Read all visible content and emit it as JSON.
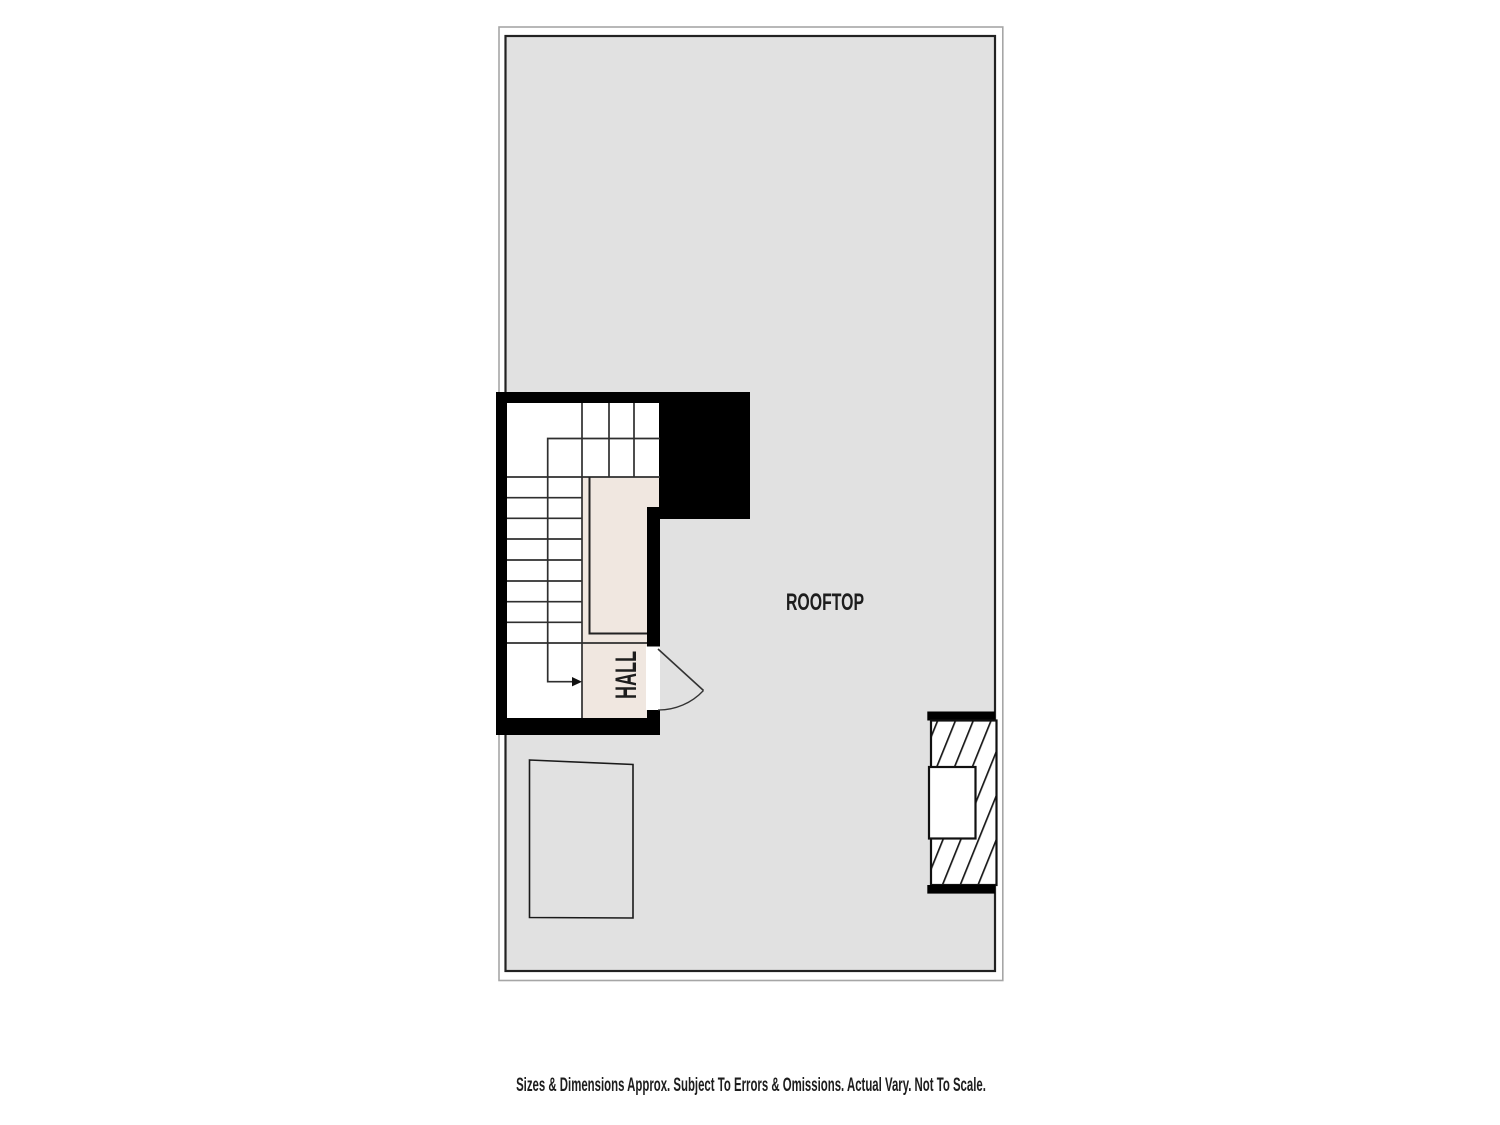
{
  "plan": {
    "labels": {
      "rooftop": "ROOFTOP",
      "hall": "HALL"
    },
    "disclaimer": "Sizes & Dimensions Approx. Subject To Errors & Omissions. Actual Vary. Not To Scale.",
    "colors": {
      "background": "#ffffff",
      "floor": "#e1e1e1",
      "floor_border": "#222222",
      "outer_border": "#a6a6a6",
      "wall": "#000000",
      "hall_floor": "#f0e7e0",
      "stair_line": "#2f2f2f",
      "text": "#1d1d1d"
    }
  }
}
